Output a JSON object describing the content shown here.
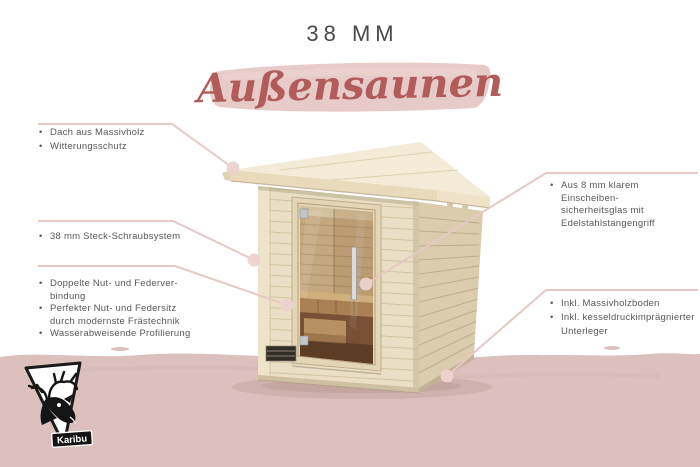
{
  "header": {
    "size_label": "38 MM",
    "title": "Außensaunen"
  },
  "callouts": {
    "roof": {
      "target": "sauna-roof",
      "bullets": [
        [
          "Dach aus Massivholz"
        ],
        [
          "Witterungsschutz"
        ]
      ]
    },
    "system": {
      "target": "sauna-wall",
      "bullets": [
        [
          "38 mm Steck-Schraubsystem"
        ]
      ]
    },
    "joints": {
      "target": "sauna-wall",
      "bullets": [
        [
          "Doppelte Nut- und Federver-",
          "bindung"
        ],
        [
          "Perfekter Nut- und Federsitz",
          "durch modernste Frästechnik"
        ],
        [
          "Wasserabweisende Profilierung"
        ]
      ]
    },
    "door": {
      "target": "door-handle",
      "bullets": [
        [
          "Aus 8 mm klarem Einscheiben-",
          "sicherheitsglas mit",
          "Edelstahlstangengriff"
        ]
      ]
    },
    "floor": {
      "target": "sauna-base",
      "bullets": [
        [
          "Inkl. Massivholzboden"
        ],
        [
          "Inkl. kesseldruckimprägnierter",
          "Unterleger"
        ]
      ]
    }
  },
  "logo": {
    "brand": "Karibu"
  },
  "palette": {
    "brush_pink": "#e7cbc8",
    "band_pink": "#dbc0bd",
    "line_pink": "#e6c9c5",
    "dot_pink": "#ecd3ce",
    "title_red": "#b15b5b",
    "heading_gray": "#48484d",
    "body_gray": "#58585c",
    "wood_light": "#eadfc4",
    "wood_shade": "#dbccae"
  }
}
